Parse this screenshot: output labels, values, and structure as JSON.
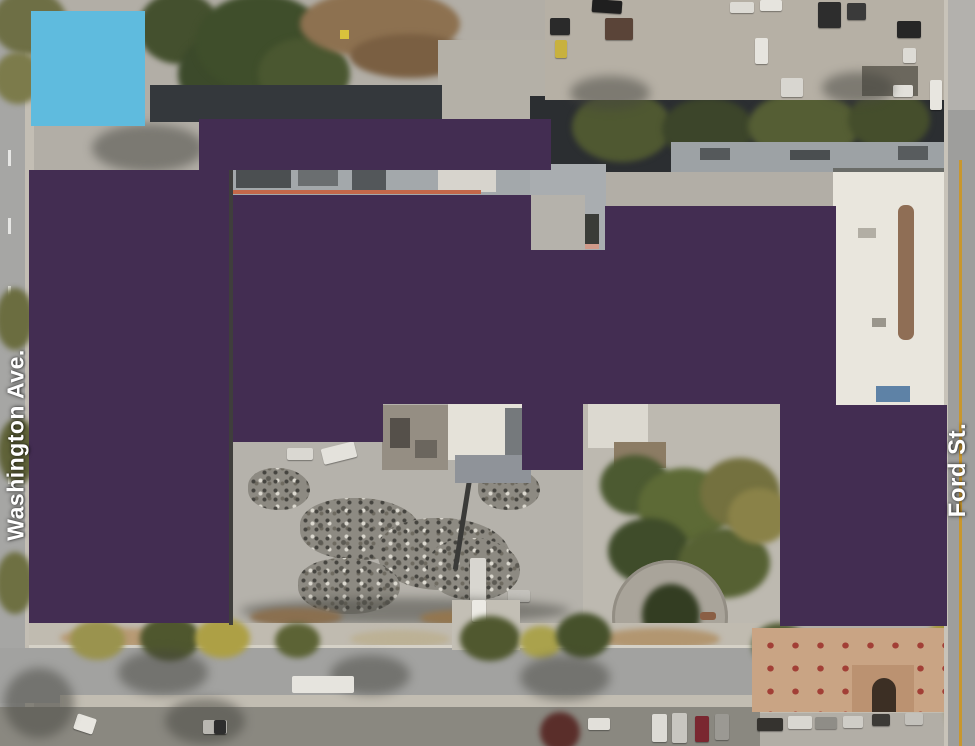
{
  "map": {
    "type": "aerial-satellite-photo",
    "streets": [
      {
        "name": "washington-ave",
        "label": "Washington Ave.",
        "side": "left",
        "orientation": "vertical"
      },
      {
        "name": "ford-st",
        "label": "Ford St.",
        "side": "right",
        "orientation": "vertical"
      }
    ],
    "label_text_color": "#ffffff",
    "overlays": {
      "purple_color": "#432d52",
      "blue_color": "#5fbbde"
    }
  }
}
